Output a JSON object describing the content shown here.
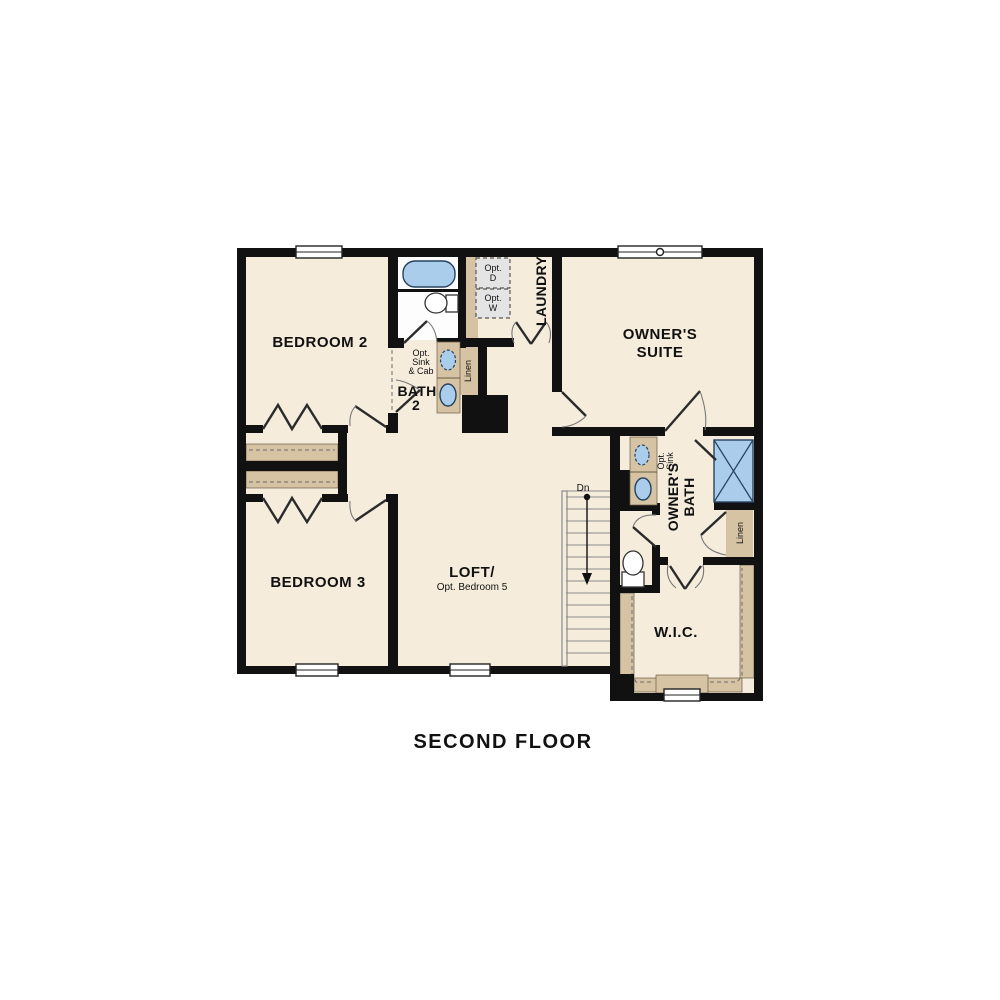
{
  "caption": "SECOND FLOOR",
  "floor_plan": {
    "rooms": {
      "bedroom2": {
        "label": "BEDROOM 2"
      },
      "bedroom3": {
        "label": "BEDROOM 3"
      },
      "owners_suite": {
        "label_line1": "OWNER'S",
        "label_line2": "SUITE"
      },
      "loft": {
        "label_line1": "LOFT/",
        "label_line2": "Opt. Bedroom 5"
      },
      "bath2": {
        "label_line1": "BATH",
        "label_line2": "2",
        "opt_note_line1": "Opt.",
        "opt_note_line2": "Sink",
        "opt_note_line3": "& Cab"
      },
      "laundry": {
        "label": "LAUNDRY",
        "opt_dryer_line1": "Opt.",
        "opt_dryer_line2": "D",
        "opt_washer_line1": "Opt.",
        "opt_washer_line2": "W"
      },
      "owners_bath": {
        "label_line1": "OWNER'S",
        "label_line2": "BATH",
        "opt_sink_line1": "Opt.",
        "opt_sink_line2": "Sink"
      },
      "wic": {
        "label": "W.I.C."
      },
      "linen_hall": {
        "label": "Linen"
      },
      "linen_owners": {
        "label": "Linen"
      },
      "stairs": {
        "direction_label": "Dn"
      }
    },
    "fixtures": [
      "bathtub",
      "toilet-bath2",
      "vanity-double-sink-bath2",
      "optional-sink-bath2",
      "washer-optional",
      "dryer-optional",
      "shower-owners-bath",
      "vanity-owners-bath",
      "optional-sink-owners-bath",
      "toilet-owners-wc",
      "closet-shelves",
      "wic-shelving"
    ],
    "colors": {
      "room_fill": "#f5ecdc",
      "wet_area_fill": "#fdfdfd",
      "casework_tan": "#d5c3a4",
      "fixture_blue": "#a9cdea",
      "wall_black": "#111111",
      "optional_appliance_gray": "#e4e4e4"
    }
  }
}
